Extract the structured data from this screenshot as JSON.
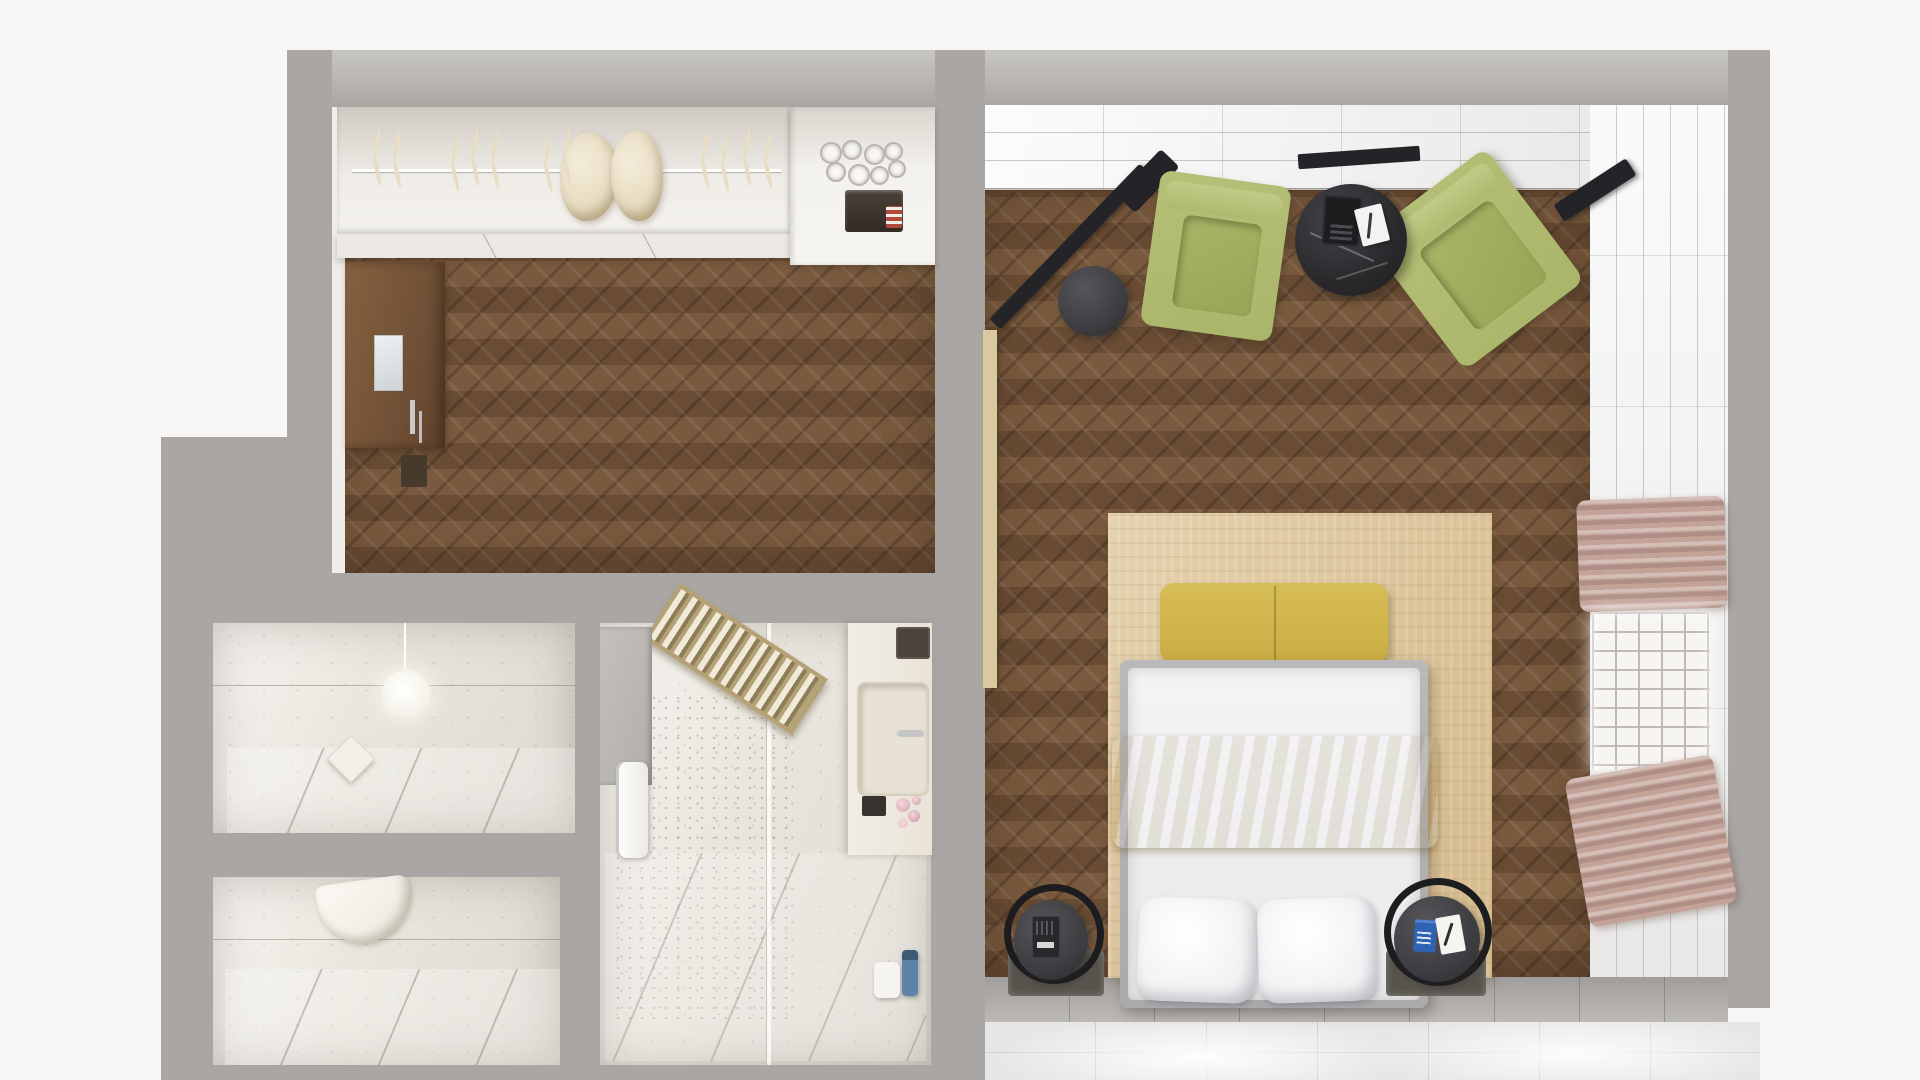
{
  "meta": {
    "title": "Top-down 3D render floor plan of a hotel suite",
    "view": "top-down render",
    "visible_text": "none"
  },
  "palette": {
    "bg": "#f7f6f4",
    "wall": "#a9a6a3",
    "wall-light": "#c8c6c3",
    "wood": "#74563c",
    "marble": "#e9e5dd",
    "tile": "#f0f0f1",
    "graytile": "#b6b3b0",
    "glossy": "#e7e6e7",
    "rug": "#dcc293",
    "bench": "#d7bd55",
    "blanket": "#cda32e",
    "chair": "#b6c078",
    "curtain": "#c3a298",
    "cream": "#e8ddc2"
  },
  "rooms": [
    {
      "id": "entry-hall",
      "label": "entry hall with herringbone parquet, wardrobe and minibar"
    },
    {
      "id": "bedroom",
      "label": "bedroom with double bed, two armchairs, round table, TV"
    },
    {
      "id": "bathroom-small",
      "label": "small marble bathroom with globe pendant lamp"
    },
    {
      "id": "toilet-room",
      "label": "marble WC room with wall-hung toilet"
    },
    {
      "id": "shower-room",
      "label": "large marble shower room with bench and vanity"
    }
  ],
  "entry_hall": {
    "closet": {
      "hangers": 11,
      "garments": 2,
      "rail": true
    },
    "minibar": {
      "glasses": 8,
      "coffee_machine": true
    },
    "entry_door": {
      "material": "wood",
      "mirror": true,
      "handle": true
    }
  },
  "bedroom": {
    "armchairs": 2,
    "coffee_table": {
      "top": "black marble",
      "items": [
        "telephone",
        "notepad with pen"
      ]
    },
    "tv": {
      "mounted_on": "stand",
      "color": "#242327"
    },
    "bed": {
      "pillows": 2,
      "throw_color": "#cda32e",
      "foot_bench_color": "#d7bd55"
    },
    "nightstands": 2,
    "curtains": 2,
    "window_lattice": true
  },
  "shower_room": {
    "bench_slatted": true,
    "glass_partition": true,
    "vanity_sink": true,
    "accessories": [
      "towel",
      "tissue box",
      "pink flowers",
      "soap box",
      "blue bottle"
    ]
  },
  "counts": {
    "flowers": 4
  }
}
